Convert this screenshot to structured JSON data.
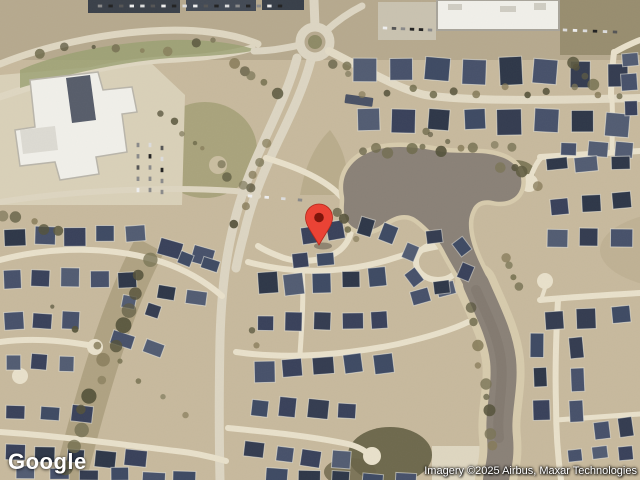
{
  "logo": {
    "text": "Google"
  },
  "attribution": {
    "text": "Imagery ©2025 Airbus, Maxar Technologies"
  },
  "marker": {
    "transform": "translate(319,245)",
    "color": "#EA4335",
    "dot_color": "#7E150C"
  },
  "map": {
    "view_type": "satellite",
    "colors": {
      "land": "#c7b99d",
      "road": "#e8e0ca",
      "main_road": "#dcd5c2",
      "water": "#8a8177",
      "bank": "#d6caac",
      "roof_dark": "#39415a",
      "tree": "#6e6a4a",
      "building_white": "#f0efe9"
    }
  }
}
